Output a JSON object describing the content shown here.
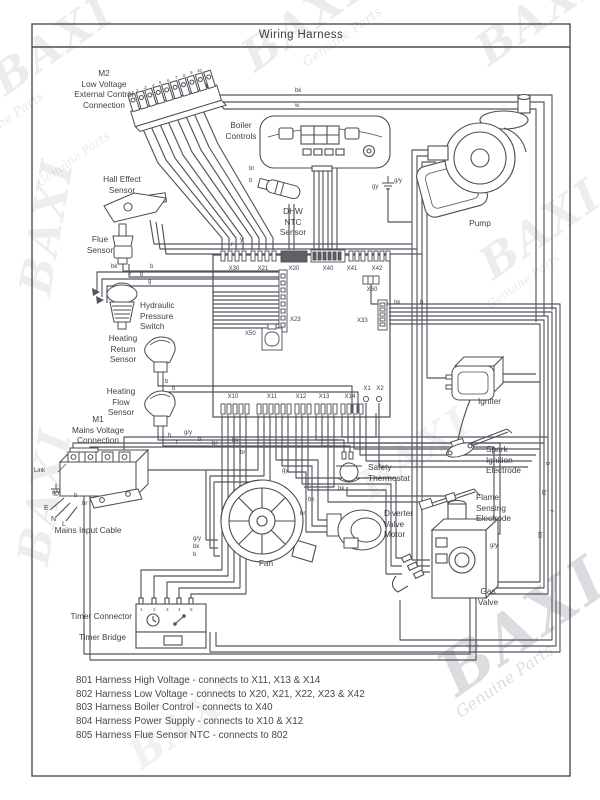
{
  "header": {
    "title": "Wiring Harness"
  },
  "watermark": {
    "brand": "BAXI",
    "sub": "Genuine Parts",
    "color": "#9aa0aa"
  },
  "watermarks": [
    {
      "t": "BAXI",
      "kind": "brand",
      "x": -18,
      "y": 64,
      "s": 44,
      "r": -35,
      "o": 0.16
    },
    {
      "t": "ne Parts",
      "kind": "sub",
      "x": -6,
      "y": 120,
      "s": 13,
      "r": -35,
      "o": 0.22
    },
    {
      "t": "BAXI",
      "kind": "brand",
      "x": 232,
      "y": 40,
      "s": 44,
      "r": -35,
      "o": 0.16
    },
    {
      "t": "Genuine Parts",
      "kind": "sub",
      "x": 300,
      "y": 58,
      "s": 13,
      "r": -35,
      "o": 0.22
    },
    {
      "t": "BAXI",
      "kind": "brand",
      "x": 466,
      "y": 34,
      "s": 44,
      "r": -35,
      "o": 0.16
    },
    {
      "t": "BAXI",
      "kind": "brand",
      "x": 10,
      "y": 290,
      "s": 44,
      "r": -80,
      "o": 0.15
    },
    {
      "t": "Genuine Parts",
      "kind": "sub",
      "x": 34,
      "y": 178,
      "s": 12,
      "r": -35,
      "o": 0.2
    },
    {
      "t": "BAXI",
      "kind": "brand",
      "x": 470,
      "y": 248,
      "s": 44,
      "r": -35,
      "o": 0.15
    },
    {
      "t": "Genuine Parts",
      "kind": "sub",
      "x": 484,
      "y": 300,
      "s": 12,
      "r": -35,
      "o": 0.2
    },
    {
      "t": "BAXI",
      "kind": "brand",
      "x": 8,
      "y": 560,
      "s": 44,
      "r": -80,
      "o": 0.15
    },
    {
      "t": "BAXI",
      "kind": "brand",
      "x": 350,
      "y": 470,
      "s": 40,
      "r": -35,
      "o": 0.12
    },
    {
      "t": "BAXI",
      "kind": "brand",
      "x": 424,
      "y": 650,
      "s": 62,
      "r": -35,
      "o": 0.3
    },
    {
      "t": "Genuine Parts",
      "kind": "sub",
      "x": 452,
      "y": 706,
      "s": 16,
      "r": -35,
      "o": 0.32
    },
    {
      "t": "BAXI",
      "kind": "brand",
      "x": 120,
      "y": 740,
      "s": 40,
      "r": -35,
      "o": 0.12
    }
  ],
  "labels": [
    {
      "n": "label-m2-connection",
      "t": "M2\nLow Voltage\nExternal Control\nConnection",
      "x": 56,
      "y": 68,
      "w": 96,
      "a": "center"
    },
    {
      "n": "label-boiler-controls",
      "t": "Boiler\nControls",
      "x": 210,
      "y": 120,
      "w": 62,
      "a": "center"
    },
    {
      "n": "label-hall-effect-sensor",
      "t": "Hall Effect\nSensor",
      "x": 82,
      "y": 174,
      "w": 80,
      "a": "center"
    },
    {
      "n": "label-dhw-ntc-sensor",
      "t": "DHW\nNTC\nSensor",
      "x": 264,
      "y": 206,
      "w": 58,
      "a": "center"
    },
    {
      "n": "label-pump",
      "t": "Pump",
      "x": 452,
      "y": 218,
      "w": 56,
      "a": "center"
    },
    {
      "n": "label-flue-sensor",
      "t": "Flue\nSensor",
      "x": 68,
      "y": 234,
      "w": 64,
      "a": "center"
    },
    {
      "n": "label-hydraulic-pressure-switch",
      "t": "Hydraulic\nPressure\nSwitch",
      "x": 140,
      "y": 300,
      "w": 76,
      "a": "left"
    },
    {
      "n": "label-heating-return-sensor",
      "t": "Heating\nReturn\nSensor",
      "x": 88,
      "y": 333,
      "w": 70,
      "a": "center"
    },
    {
      "n": "label-heating-flow-sensor",
      "t": "Heating\nFlow\nSensor",
      "x": 86,
      "y": 386,
      "w": 70,
      "a": "center"
    },
    {
      "n": "label-m1-connection",
      "t": "M1\nMains Voltage\nConnection",
      "x": 48,
      "y": 414,
      "w": 100,
      "a": "center"
    },
    {
      "n": "label-mains-input-cable",
      "t": "Mains Input Cable",
      "x": 36,
      "y": 525,
      "w": 104,
      "a": "center"
    },
    {
      "n": "label-safety-thermostat",
      "t": "Safety\nThermostat",
      "x": 368,
      "y": 462,
      "w": 78,
      "a": "left"
    },
    {
      "n": "label-diverter-valve-motor",
      "t": "Diverter\nValve\nMotor",
      "x": 384,
      "y": 508,
      "w": 64,
      "a": "left"
    },
    {
      "n": "label-fan",
      "t": "Fan",
      "x": 246,
      "y": 558,
      "w": 40,
      "a": "center"
    },
    {
      "n": "label-igniter",
      "t": "Igniter",
      "x": 478,
      "y": 396,
      "w": 44,
      "a": "left"
    },
    {
      "n": "label-spark-ignition-electrode",
      "t": "Spark\nIgnition\nElectrode",
      "x": 486,
      "y": 444,
      "w": 66,
      "a": "left"
    },
    {
      "n": "label-flame-sensing-electrode",
      "t": "Flame\nSensing\nElectrode",
      "x": 476,
      "y": 492,
      "w": 66,
      "a": "left"
    },
    {
      "n": "label-gas-valve",
      "t": "Gas\nValve",
      "x": 466,
      "y": 586,
      "w": 44,
      "a": "center"
    },
    {
      "n": "label-timer-connector",
      "t": "Timer Connector",
      "x": 40,
      "y": 611,
      "w": 92,
      "a": "right"
    },
    {
      "n": "label-timer-bridge",
      "t": "Timer Bridge",
      "x": 40,
      "y": 632,
      "w": 86,
      "a": "right"
    },
    {
      "n": "label-x30",
      "t": "X30",
      "x": 222,
      "y": 266,
      "w": 24,
      "a": "center",
      "s": 6
    },
    {
      "n": "label-x21",
      "t": "X21",
      "x": 251,
      "y": 266,
      "w": 24,
      "a": "center",
      "s": 6
    },
    {
      "n": "label-x20",
      "t": "X20",
      "x": 282,
      "y": 266,
      "w": 24,
      "a": "center",
      "s": 6
    },
    {
      "n": "label-x40",
      "t": "X40",
      "x": 316,
      "y": 266,
      "w": 24,
      "a": "center",
      "s": 6
    },
    {
      "n": "label-x41",
      "t": "X41",
      "x": 340,
      "y": 266,
      "w": 24,
      "a": "center",
      "s": 6
    },
    {
      "n": "label-x42",
      "t": "X42",
      "x": 365,
      "y": 266,
      "w": 24,
      "a": "center",
      "s": 6
    },
    {
      "n": "label-x60",
      "t": "X60",
      "x": 360,
      "y": 287,
      "w": 24,
      "a": "center",
      "s": 6
    },
    {
      "n": "label-x23",
      "t": "X23",
      "x": 290,
      "y": 317,
      "w": 20,
      "a": "left",
      "s": 6
    },
    {
      "n": "label-x50",
      "t": "X50",
      "x": 245,
      "y": 331,
      "w": 20,
      "a": "left",
      "s": 6
    },
    {
      "n": "label-x33",
      "t": "X33",
      "x": 357,
      "y": 318,
      "w": 20,
      "a": "left",
      "s": 6
    },
    {
      "n": "label-x10",
      "t": "X10",
      "x": 221,
      "y": 394,
      "w": 24,
      "a": "center",
      "s": 6
    },
    {
      "n": "label-x11",
      "t": "X11",
      "x": 260,
      "y": 394,
      "w": 24,
      "a": "center",
      "s": 6
    },
    {
      "n": "label-x12",
      "t": "X12",
      "x": 289,
      "y": 394,
      "w": 24,
      "a": "center",
      "s": 6
    },
    {
      "n": "label-x13",
      "t": "X13",
      "x": 312,
      "y": 394,
      "w": 24,
      "a": "center",
      "s": 6
    },
    {
      "n": "label-x14",
      "t": "X14",
      "x": 338,
      "y": 394,
      "w": 24,
      "a": "center",
      "s": 6
    },
    {
      "n": "label-x1",
      "t": "X1",
      "x": 360,
      "y": 386,
      "w": 14,
      "a": "center",
      "s": 6
    },
    {
      "n": "label-x2",
      "t": "X2",
      "x": 373,
      "y": 386,
      "w": 14,
      "a": "center",
      "s": 6
    },
    {
      "n": "label-link",
      "t": "Link",
      "x": 34,
      "y": 468,
      "w": 26,
      "a": "left",
      "s": 6
    },
    {
      "n": "label-earth-e",
      "t": "E",
      "x": 44,
      "y": 505,
      "w": 10,
      "a": "left",
      "s": 7
    },
    {
      "n": "label-neutral-n",
      "t": "N",
      "x": 51,
      "y": 516,
      "w": 10,
      "a": "left",
      "s": 7
    },
    {
      "n": "label-live-l",
      "t": "L",
      "x": 62,
      "y": 521,
      "w": 10,
      "a": "left",
      "s": 7
    }
  ],
  "wire_labels": [
    {
      "t": "bk",
      "x": 295,
      "y": 88
    },
    {
      "t": "w",
      "x": 295,
      "y": 103
    },
    {
      "t": "br",
      "x": 249,
      "y": 166
    },
    {
      "t": "b",
      "x": 249,
      "y": 178
    },
    {
      "t": "gy",
      "x": 372,
      "y": 184
    },
    {
      "t": "g/y",
      "x": 394,
      "y": 178
    },
    {
      "t": "y",
      "x": 240,
      "y": 237
    },
    {
      "t": "r",
      "x": 231,
      "y": 242
    },
    {
      "t": "b",
      "x": 150,
      "y": 264
    },
    {
      "t": "b",
      "x": 140,
      "y": 272
    },
    {
      "t": "bk",
      "x": 111,
      "y": 264
    },
    {
      "t": "r",
      "x": 130,
      "y": 271
    },
    {
      "t": "g",
      "x": 148,
      "y": 279
    },
    {
      "t": "b",
      "x": 165,
      "y": 379
    },
    {
      "t": "b",
      "x": 172,
      "y": 386
    },
    {
      "t": "b",
      "x": 168,
      "y": 433
    },
    {
      "t": "r",
      "x": 176,
      "y": 440
    },
    {
      "t": "g/y",
      "x": 184,
      "y": 430
    },
    {
      "t": "b",
      "x": 198,
      "y": 437
    },
    {
      "t": "br",
      "x": 212,
      "y": 441
    },
    {
      "t": "g/y",
      "x": 52,
      "y": 490
    },
    {
      "t": "b",
      "x": 74,
      "y": 493
    },
    {
      "t": "br",
      "x": 82,
      "y": 501
    },
    {
      "t": "bk",
      "x": 308,
      "y": 497
    },
    {
      "t": "br",
      "x": 300,
      "y": 511
    },
    {
      "t": "g/y",
      "x": 193,
      "y": 536
    },
    {
      "t": "bk",
      "x": 193,
      "y": 544
    },
    {
      "t": "b",
      "x": 193,
      "y": 552
    },
    {
      "t": "bk",
      "x": 338,
      "y": 486
    },
    {
      "t": "gy",
      "x": 282,
      "y": 468
    },
    {
      "t": "bk",
      "x": 232,
      "y": 438
    },
    {
      "t": "br",
      "x": 240,
      "y": 450
    },
    {
      "t": "b",
      "x": 550,
      "y": 462,
      "r": 90
    },
    {
      "t": "br",
      "x": 546,
      "y": 490,
      "r": 90
    },
    {
      "t": "r",
      "x": 554,
      "y": 510,
      "r": 90
    },
    {
      "t": "bk",
      "x": 542,
      "y": 532,
      "r": 90
    },
    {
      "t": "g/y",
      "x": 490,
      "y": 543
    },
    {
      "t": "bk",
      "x": 394,
      "y": 300
    },
    {
      "t": "b",
      "x": 420,
      "y": 300
    }
  ],
  "pin_digits": [
    {
      "t": "1",
      "x": 128,
      "y": 90
    },
    {
      "t": "2",
      "x": 136,
      "y": 88
    },
    {
      "t": "3",
      "x": 144,
      "y": 85
    },
    {
      "t": "4",
      "x": 152,
      "y": 83
    },
    {
      "t": "5",
      "x": 159,
      "y": 80
    },
    {
      "t": "6",
      "x": 167,
      "y": 78
    },
    {
      "t": "7",
      "x": 175,
      "y": 75
    },
    {
      "t": "8",
      "x": 183,
      "y": 73
    },
    {
      "t": "9",
      "x": 190,
      "y": 70
    },
    {
      "t": "10",
      "x": 197,
      "y": 68
    },
    {
      "t": "1",
      "x": 140,
      "y": 607
    },
    {
      "t": "2",
      "x": 153,
      "y": 607
    },
    {
      "t": "3",
      "x": 166,
      "y": 607
    },
    {
      "t": "4",
      "x": 178,
      "y": 607
    },
    {
      "t": "5",
      "x": 190,
      "y": 607
    }
  ],
  "legend": {
    "lines": [
      "801 Harness High Voltage - connects to X11, X13 & X14",
      "802 Harness Low Voltage - connects to X20, X21, X22, X23 & X42",
      "803 Harness Boiler Control - connects to X40",
      "804 Harness Power Supply - connects to X10 & X12",
      "805 Harness Flue Sensor NTC - connects to 802"
    ]
  }
}
